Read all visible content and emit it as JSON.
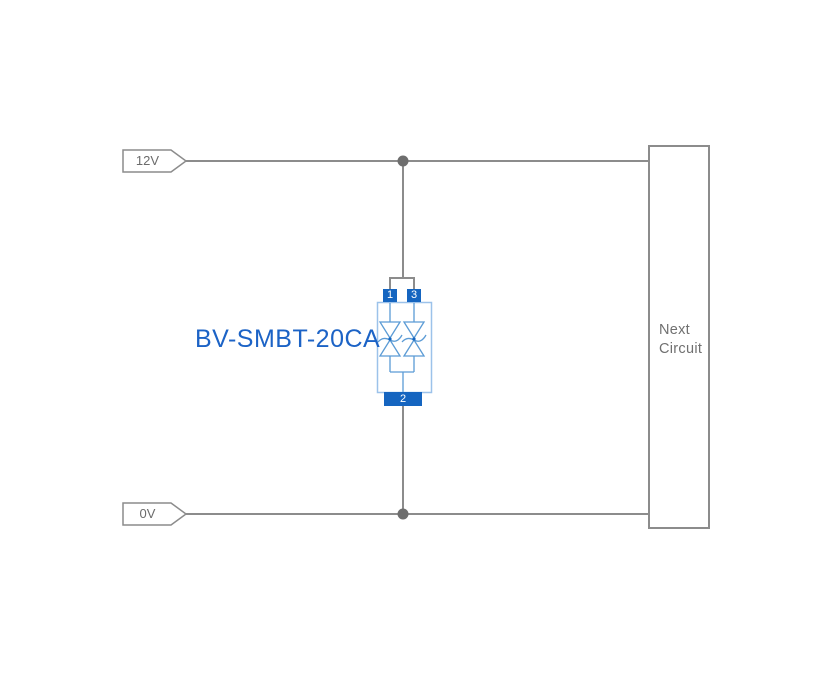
{
  "circuit": {
    "power_rail": {
      "label": "12V"
    },
    "ground_rail": {
      "label": "0V"
    },
    "component": {
      "label": "BV-SMBT-20CA",
      "pins": {
        "pin1": "1",
        "pin2": "2",
        "pin3": "3"
      }
    },
    "next_circuit": {
      "line1": "Next",
      "line2": "Circuit"
    }
  },
  "colors": {
    "background": "#ffffff",
    "wire": "#8c8c8c",
    "junction_dot": "#6e6e6e",
    "flag_outline": "#8c8c8c",
    "rail_text": "#6b6b6b",
    "pin_fill": "#1565c0",
    "pin_text": "#ffffff",
    "component_body_outline": "#9cc2ea",
    "diode_symbol": "#5b9bd5",
    "component_label_text": "#1c63c6",
    "next_circuit_box_outline": "#8c8c8c",
    "next_circuit_text": "#707070"
  }
}
